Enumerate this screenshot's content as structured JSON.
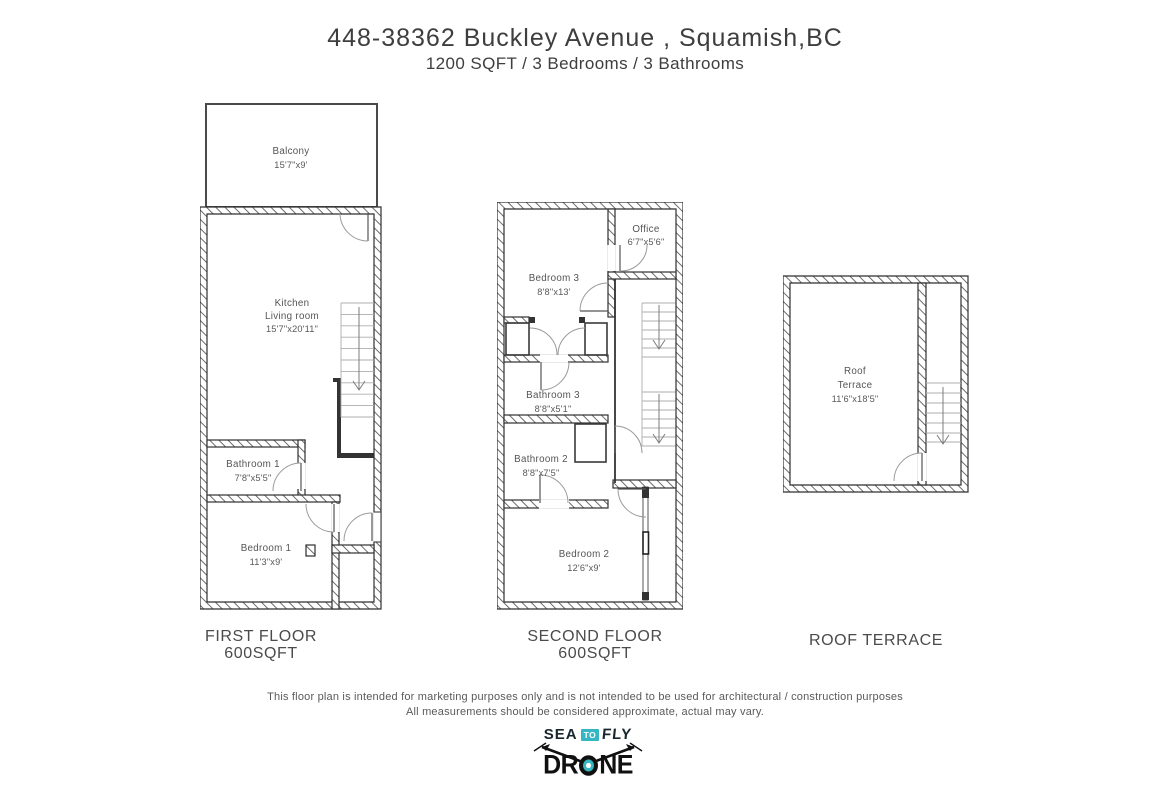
{
  "header": {
    "title": "448-38362 Buckley Avenue , Squamish,BC",
    "subtitle": "1200 SQFT / 3 Bedrooms / 3 Bathrooms"
  },
  "plans": {
    "first": {
      "caption_line1": "FIRST FLOOR",
      "caption_line2": "600SQFT",
      "rooms": {
        "balcony": {
          "name": "Balcony",
          "dims": "15'7\"x9'"
        },
        "kitchen": {
          "name": "Kitchen",
          "name2": "Living room",
          "dims": "15'7\"x20'11\""
        },
        "bathroom1": {
          "name": "Bathroom 1",
          "dims": "7'8\"x5'5\""
        },
        "bedroom1": {
          "name": "Bedroom 1",
          "dims": "11'3\"x9'"
        }
      }
    },
    "second": {
      "caption_line1": "SECOND FLOOR",
      "caption_line2": "600SQFT",
      "rooms": {
        "bedroom3": {
          "name": "Bedroom 3",
          "dims": "8'8\"x13'"
        },
        "office": {
          "name": "Office",
          "dims": "6'7\"x5'6\""
        },
        "bathroom3": {
          "name": "Bathroom 3",
          "dims": "8'8\"x5'1\""
        },
        "bathroom2": {
          "name": "Bathroom 2",
          "dims": "8'8\"x7'5\""
        },
        "bedroom2": {
          "name": "Bedroom 2",
          "dims": "12'6\"x9'"
        }
      }
    },
    "roof": {
      "caption_line1": "ROOF TERRACE",
      "rooms": {
        "terrace": {
          "name1": "Roof",
          "name2": "Terrace",
          "dims": "11'6\"x18'5\""
        }
      }
    }
  },
  "disclaimer": {
    "line1": "This floor plan is intended for marketing purposes only and is not intended to be used for architectural / construction purposes",
    "line2": "All measurements should be considered approximate, actual may vary."
  },
  "logo": {
    "sea": "SEA",
    "to": "TO",
    "fly": "FLY",
    "drone_left": "DR",
    "drone_right": "NE"
  },
  "colors": {
    "teal": "#35b6c3",
    "wall": "#2f2f2f",
    "text": "#4a4a4a"
  }
}
